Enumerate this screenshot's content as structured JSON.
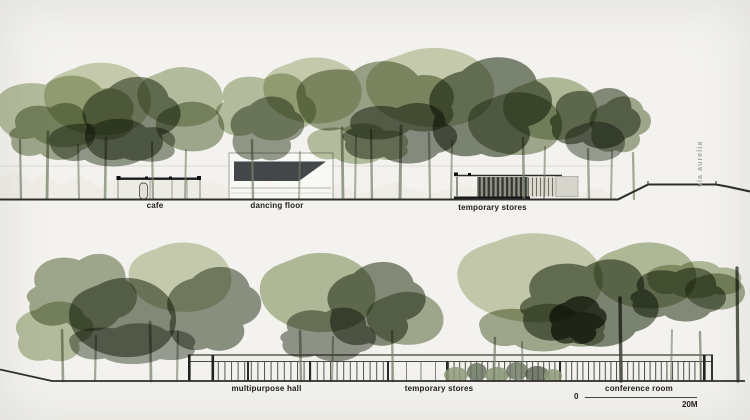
{
  "palette": {
    "paper": "#f3f2ee",
    "green_light": "#c6cdac",
    "green_soft": "#aab690",
    "green_mid": "#8e9a7a",
    "green_dark": "#6a7460",
    "green_deep": "#4e5646",
    "trunk": "#76806a",
    "ink": "#2e2e2a"
  },
  "top_section": {
    "cafe_label": "cafe",
    "dancing_floor_label": "dancing floor",
    "temporary_stores_label": "temporary stores",
    "road_label": "via aurelia"
  },
  "bottom_section": {
    "multipurpose_hall_label": "multipurpose hall",
    "temporary_stores_label": "temporary stores",
    "conference_room_label": "conference room"
  },
  "scale_bar": {
    "zero_label": "0",
    "end_label": "20M"
  }
}
